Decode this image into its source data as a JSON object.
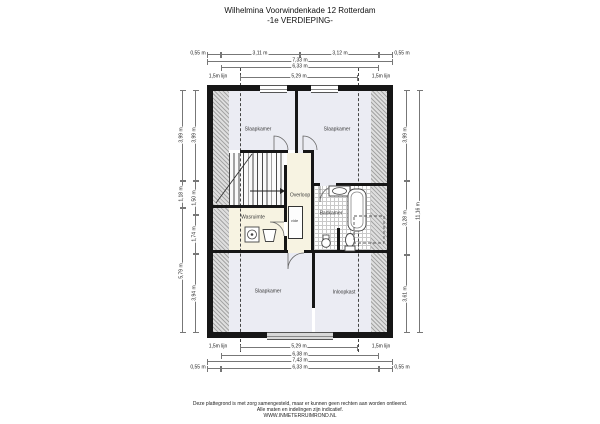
{
  "header": {
    "title": "Wilhelmina Voorwindenkade 12 Rotterdam",
    "subtitle": "-1e VERDIEPING-"
  },
  "rooms": {
    "slaapkamer_tl": "Slaapkamer",
    "slaapkamer_tr": "Slaapkamer",
    "overloop": "Overloop",
    "badkamer": "Badkamer",
    "wasruimte": "Wasruimte",
    "slaapkamer_b": "Slaapkamer",
    "inloopkast": "Inloopkast",
    "shaft": "vide"
  },
  "fixtures": {
    "washer": "wasmachine",
    "basket": "wasmand",
    "bath": "ligbad",
    "sink": "wastafel",
    "toilet": "toilet"
  },
  "dims": {
    "top": {
      "row1": [
        "0,55 m",
        "3,11 m",
        "3,12 m",
        "0,55 m"
      ],
      "total": "7,33 m",
      "inner": "6,33 m",
      "lijn_left": "1,5m lijn",
      "mid": "5,29 m",
      "lijn_right": "1,5m lijn"
    },
    "bottom": {
      "lijn_left": "1,5m lijn",
      "mid": "5,29 m",
      "lijn_right": "1,5m lijn",
      "inner": "6,38 m",
      "total": "7,43 m",
      "row4": [
        "0,55 m",
        "6,33 m",
        "0,55 m"
      ]
    },
    "left": {
      "outer": [
        "3,99 m",
        "1,18 m",
        "5,79 m"
      ],
      "inner": [
        "3,99 m",
        "1,50 m",
        "1,74 m",
        "3,94 m"
      ]
    },
    "right": {
      "inner": [
        "3,99 m",
        "3,28 m",
        "3,61 m"
      ],
      "outer": "11,16 m"
    }
  },
  "footer": {
    "line1": "Deze plattegrond is met zorg samengesteld, maar er kunnen geen rechten aan worden ontleend.",
    "line2": "Alle maten en indelingen zijn indicatief.",
    "line3": "WWW.INMETERRUIMROND.NL"
  },
  "colors": {
    "wall": "#161616",
    "floor_light": "#ebecf3",
    "floor_cream": "#f7f3e2",
    "hatch_gray": "#a5a5a5",
    "dim_line": "#777777"
  }
}
